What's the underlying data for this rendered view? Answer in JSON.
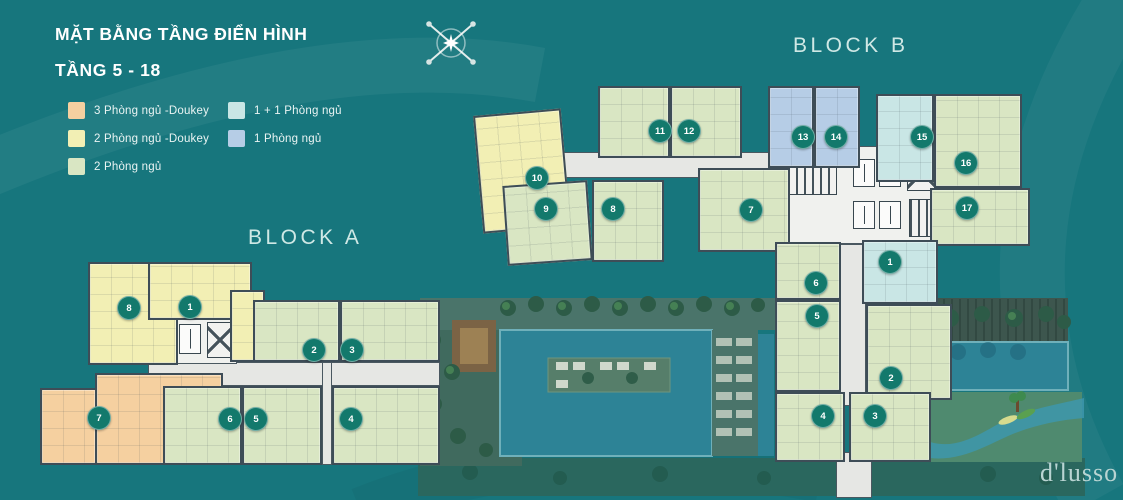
{
  "title": {
    "line1": "MẶT BẰNG TẦNG ĐIỂN HÌNH",
    "line2": "TẦNG 5 - 18"
  },
  "legend": {
    "items": [
      {
        "label": "3 Phòng ngủ -Doukey",
        "color": "#f5d0a0",
        "column": 1
      },
      {
        "label": "2 Phòng ngủ -Doukey",
        "color": "#f2efb4",
        "column": 1
      },
      {
        "label": "2 Phòng ngủ",
        "color": "#d9e6c3",
        "column": 1
      },
      {
        "label": "1 + 1 Phòng ngủ",
        "color": "#c9e6e5",
        "column": 2
      },
      {
        "label": "1 Phòng ngủ",
        "color": "#b6cde6",
        "column": 2
      }
    ]
  },
  "blocks": {
    "a": "BLOCK A",
    "b": "BLOCK B"
  },
  "logo": "d'lusso",
  "background_color": "#17767d",
  "badge_color": "#13796c",
  "unit_types": {
    "3br_dualkey": {
      "label": "3 Phòng ngủ -Doukey",
      "color": "#f5d0a0"
    },
    "2br_dualkey": {
      "label": "2 Phòng ngủ -Doukey",
      "color": "#f2efb4"
    },
    "2br": {
      "label": "2 Phòng ngủ",
      "color": "#d9e6c3"
    },
    "1p1br": {
      "label": "1 + 1 Phòng ngủ",
      "color": "#c9e6e5"
    },
    "1br": {
      "label": "1 Phòng ngủ",
      "color": "#b6cde6"
    }
  },
  "units": [
    {
      "block": "A",
      "number": "8",
      "type": "2br_dualkey",
      "rects": [
        [
          88,
          262,
          90,
          103
        ]
      ],
      "badge": [
        128,
        307
      ]
    },
    {
      "block": "A",
      "number": "1",
      "type": "2br_dualkey",
      "rects": [
        [
          148,
          262,
          104,
          58
        ],
        [
          230,
          290,
          35,
          72
        ]
      ],
      "badge": [
        189,
        306
      ]
    },
    {
      "block": "A",
      "number": "7",
      "type": "3br_dualkey",
      "rects": [
        [
          95,
          373,
          128,
          92
        ],
        [
          40,
          388,
          57,
          77
        ]
      ],
      "badge": [
        98,
        417
      ]
    },
    {
      "block": "A",
      "number": "2",
      "type": "2br",
      "rects": [
        [
          253,
          300,
          87,
          62
        ]
      ],
      "badge": [
        313,
        349
      ]
    },
    {
      "block": "A",
      "number": "3",
      "type": "2br",
      "rects": [
        [
          340,
          300,
          100,
          62
        ]
      ],
      "badge": [
        351,
        349
      ]
    },
    {
      "block": "A",
      "number": "6",
      "type": "2br",
      "rects": [
        [
          163,
          386,
          79,
          79
        ]
      ],
      "badge": [
        229,
        418
      ]
    },
    {
      "block": "A",
      "number": "5",
      "type": "2br",
      "rects": [
        [
          242,
          386,
          80,
          79
        ]
      ],
      "badge": [
        255,
        418
      ]
    },
    {
      "block": "A",
      "number": "4",
      "type": "2br",
      "rects": [
        [
          332,
          386,
          108,
          79
        ]
      ],
      "badge": [
        350,
        418
      ]
    },
    {
      "block": "B",
      "number": "10",
      "type": "2br_dualkey",
      "rects": [
        [
          478,
          112,
          88,
          118
        ]
      ],
      "rot": -5,
      "badge": [
        536,
        177
      ]
    },
    {
      "block": "B",
      "number": "9",
      "type": "2br",
      "rects": [
        [
          505,
          183,
          85,
          80
        ]
      ],
      "rot": -4,
      "badge": [
        545,
        208
      ]
    },
    {
      "block": "B",
      "number": "8",
      "type": "2br",
      "rects": [
        [
          592,
          180,
          72,
          82
        ]
      ],
      "badge": [
        612,
        208
      ]
    },
    {
      "block": "B",
      "number": "11",
      "type": "2br",
      "rects": [
        [
          598,
          86,
          72,
          72
        ]
      ],
      "badge": [
        659,
        130
      ]
    },
    {
      "block": "B",
      "number": "12",
      "type": "2br",
      "rects": [
        [
          670,
          86,
          72,
          72
        ]
      ],
      "badge": [
        688,
        130
      ]
    },
    {
      "block": "B",
      "number": "13",
      "type": "1br",
      "rects": [
        [
          768,
          86,
          46,
          82
        ]
      ],
      "badge": [
        802,
        136
      ]
    },
    {
      "block": "B",
      "number": "14",
      "type": "1br",
      "rects": [
        [
          814,
          86,
          46,
          82
        ]
      ],
      "badge": [
        835,
        136
      ]
    },
    {
      "block": "B",
      "number": "15",
      "type": "1p1br",
      "rects": [
        [
          876,
          94,
          58,
          88
        ]
      ],
      "badge": [
        921,
        136
      ]
    },
    {
      "block": "B",
      "number": "16",
      "type": "2br",
      "rects": [
        [
          934,
          94,
          88,
          94
        ]
      ],
      "badge": [
        965,
        162
      ]
    },
    {
      "block": "B",
      "number": "17",
      "type": "2br",
      "rects": [
        [
          930,
          188,
          100,
          58
        ]
      ],
      "badge": [
        966,
        207
      ]
    },
    {
      "block": "B",
      "number": "7",
      "type": "2br",
      "rects": [
        [
          698,
          168,
          92,
          84
        ]
      ],
      "badge": [
        750,
        209
      ]
    },
    {
      "block": "B",
      "number": "6",
      "type": "2br",
      "rects": [
        [
          775,
          242,
          66,
          58
        ]
      ],
      "badge": [
        815,
        282
      ]
    },
    {
      "block": "B",
      "number": "5",
      "type": "2br",
      "rects": [
        [
          775,
          300,
          66,
          92
        ]
      ],
      "badge": [
        816,
        315
      ]
    },
    {
      "block": "B",
      "number": "1",
      "type": "1p1br",
      "rects": [
        [
          862,
          240,
          76,
          64
        ]
      ],
      "badge": [
        889,
        261
      ]
    },
    {
      "block": "B",
      "number": "2",
      "type": "2br",
      "rects": [
        [
          866,
          304,
          86,
          96
        ]
      ],
      "badge": [
        890,
        377
      ]
    },
    {
      "block": "B",
      "number": "4",
      "type": "2br",
      "rects": [
        [
          775,
          392,
          70,
          70
        ]
      ],
      "badge": [
        822,
        415
      ]
    },
    {
      "block": "B",
      "number": "3",
      "type": "2br",
      "rects": [
        [
          849,
          392,
          82,
          70
        ]
      ],
      "badge": [
        874,
        415
      ]
    }
  ]
}
